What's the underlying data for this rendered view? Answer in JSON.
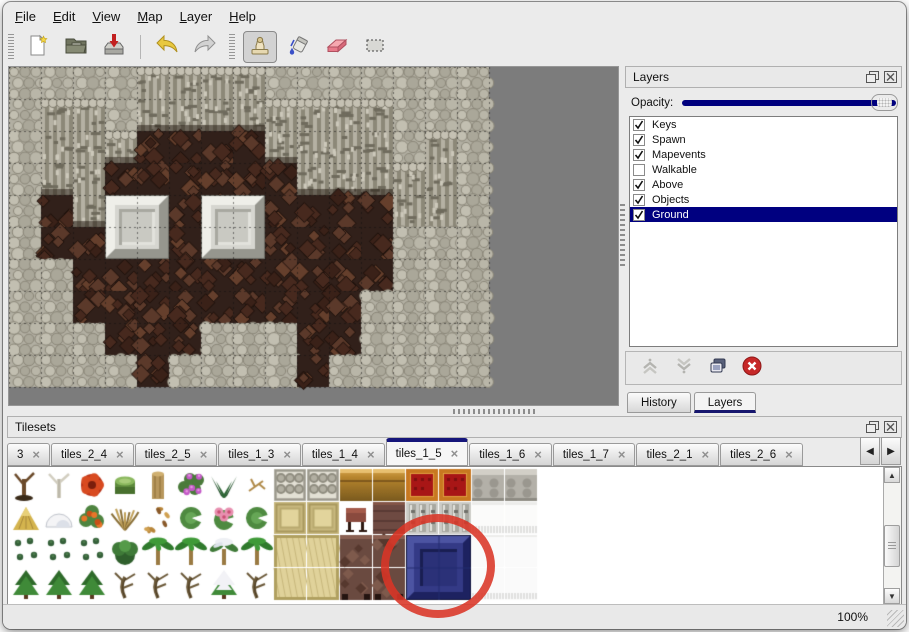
{
  "menu_bar": {
    "items": [
      "File",
      "Edit",
      "View",
      "Map",
      "Layer",
      "Help"
    ]
  },
  "toolbar": {
    "groups": [
      [
        "new-file",
        "open-folder",
        "save"
      ],
      [
        "undo",
        "redo"
      ],
      [
        "stamp-tool",
        "fill-tool",
        "eraser-tool",
        "select-tool"
      ]
    ],
    "selected_tool": "stamp-tool"
  },
  "layers_panel": {
    "title": "Layers",
    "header_icons": [
      "float-panel",
      "close-panel"
    ],
    "opacity_label": "Opacity:",
    "opacity_slider_position": 1.0,
    "layers": [
      {
        "name": "Keys",
        "checked": true,
        "selected": false
      },
      {
        "name": "Spawn",
        "checked": true,
        "selected": false
      },
      {
        "name": "Mapevents",
        "checked": true,
        "selected": false
      },
      {
        "name": "Walkable",
        "checked": false,
        "selected": false
      },
      {
        "name": "Above",
        "checked": true,
        "selected": false
      },
      {
        "name": "Objects",
        "checked": true,
        "selected": false
      },
      {
        "name": "Ground",
        "checked": true,
        "selected": true
      }
    ],
    "action_icons": [
      "move-layer-up",
      "move-layer-down",
      "duplicate-layer",
      "delete-layer"
    ],
    "bottom_tabs": [
      {
        "label": "History",
        "active": false
      },
      {
        "label": "Layers",
        "active": true
      }
    ]
  },
  "tilesets_panel": {
    "title": "Tilesets",
    "header_icons": [
      "float-panel",
      "close-panel"
    ],
    "tabs": [
      {
        "label": "3",
        "active": false
      },
      {
        "label": "tiles_2_4",
        "active": false
      },
      {
        "label": "tiles_2_5",
        "active": false
      },
      {
        "label": "tiles_1_3",
        "active": false
      },
      {
        "label": "tiles_1_4",
        "active": false
      },
      {
        "label": "tiles_1_5",
        "active": true
      },
      {
        "label": "tiles_1_6",
        "active": false
      },
      {
        "label": "tiles_1_7",
        "active": false
      },
      {
        "label": "tiles_2_1",
        "active": false
      },
      {
        "label": "tiles_2_6",
        "active": false
      }
    ],
    "scroll_icons": [
      "scroll-tabs-left",
      "scroll-tabs-right"
    ]
  },
  "status_bar": {
    "zoom_level": "100%"
  },
  "map_view": {
    "tile_size": 32,
    "legend": {
      "S": "rock-ground",
      "C": "cliff-face",
      "F": "cave-floor"
    },
    "grid": [
      [
        "S",
        "S",
        "S",
        "S",
        "C",
        "C",
        "C",
        "C",
        "S",
        "S",
        "S",
        "S",
        "S",
        "S",
        "S"
      ],
      [
        "S",
        "C",
        "C",
        "S",
        "C",
        "C",
        "C",
        "C",
        "C",
        "C",
        "C",
        "C",
        "S",
        "S",
        "S"
      ],
      [
        "S",
        "C",
        "C",
        "C",
        "F",
        "F",
        "F",
        "F",
        "C",
        "C",
        "C",
        "C",
        "S",
        "C",
        "S"
      ],
      [
        "S",
        "C",
        "C",
        "F",
        "F",
        "F",
        "F",
        "F",
        "F",
        "C",
        "C",
        "C",
        "C",
        "C",
        "S"
      ],
      [
        "S",
        "F",
        "C",
        "F",
        "F",
        "F",
        "F",
        "F",
        "F",
        "F",
        "F",
        "F",
        "C",
        "C",
        "S"
      ],
      [
        "S",
        "F",
        "F",
        "F",
        "F",
        "F",
        "F",
        "F",
        "F",
        "F",
        "F",
        "F",
        "S",
        "S",
        "S"
      ],
      [
        "S",
        "S",
        "F",
        "F",
        "F",
        "F",
        "F",
        "F",
        "F",
        "F",
        "F",
        "F",
        "S",
        "S",
        "S"
      ],
      [
        "S",
        "S",
        "F",
        "F",
        "F",
        "F",
        "F",
        "F",
        "F",
        "F",
        "F",
        "S",
        "S",
        "S",
        "S"
      ],
      [
        "S",
        "S",
        "S",
        "F",
        "F",
        "F",
        "S",
        "S",
        "S",
        "F",
        "F",
        "S",
        "S",
        "S",
        "S"
      ],
      [
        "S",
        "S",
        "S",
        "S",
        "F",
        "S",
        "S",
        "S",
        "S",
        "F",
        "S",
        "S",
        "S",
        "S",
        "S"
      ]
    ],
    "pedestals": [
      [
        4,
        3
      ],
      [
        4,
        6
      ]
    ]
  },
  "palette": {
    "tile_size": 32,
    "grid": [
      [
        "dead-tree",
        "white-tree",
        "red-flower",
        "green-stump",
        "trunk",
        "purple-flowers",
        "fern",
        "twig",
        "stone-floor",
        "stone-floor",
        "gold-table",
        "gold-table",
        "red-carpet",
        "red-carpet",
        "gray-stone",
        "gray-stone"
      ],
      [
        "hay-pile",
        "snow-pile",
        "orange-flowers",
        "dry-grass",
        "leaves",
        "lily-pad",
        "pink-lily",
        "lily-pad",
        "tan-carpet",
        "tan-carpet",
        "maroon-stool",
        "brown-panel",
        "pillar",
        "pillar",
        "white-fringe",
        "white-fringe"
      ],
      [
        "sprigs",
        "sprigs",
        "sprigs",
        "bush",
        "palm",
        "palm",
        "snow-tree",
        "palm",
        "tan-carpet-big",
        "tan-carpet-big",
        "brown-big",
        "brown-big",
        "blue-tile",
        "blue-tile",
        "white-big",
        "white-big"
      ],
      [
        "conifer",
        "conifer",
        "conifer",
        "gnarled-tree",
        "gnarled-tree",
        "gnarled-tree",
        "snow-conifer",
        "gnarled-tree",
        "tan-carpet-big",
        "tan-carpet-big",
        "brown-big",
        "brown-big",
        "blue-tile",
        "blue-tile",
        "white-big",
        "white-big"
      ]
    ],
    "selected_tile": {
      "row": 2,
      "col": 12,
      "span": 2,
      "color": "#2f3580"
    },
    "annotation": {
      "shape": "ellipse",
      "color": "#d93425"
    }
  },
  "colors": {
    "selection_navy": "#000080",
    "window_bg": "#ebebeb",
    "canvas_gray": "#7c7c7c",
    "annotation_red": "#d93425"
  }
}
